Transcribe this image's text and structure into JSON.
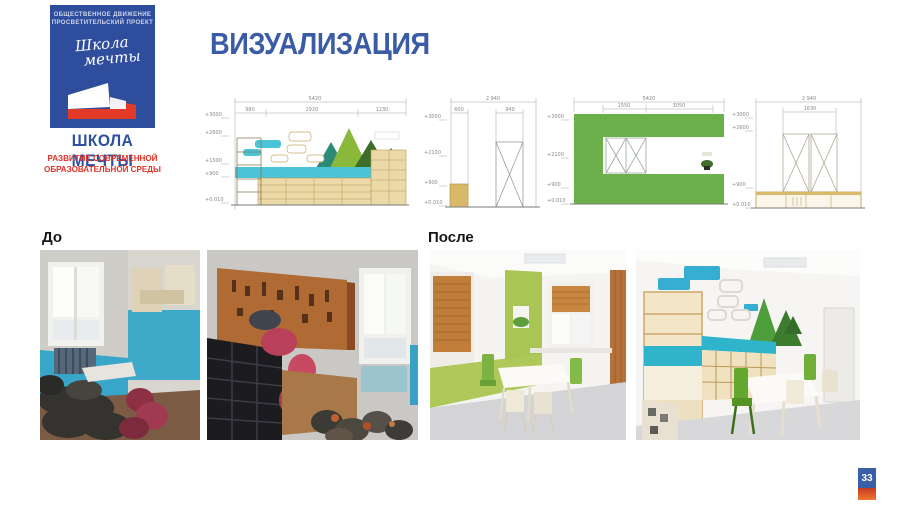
{
  "slide": {
    "title": "ВИЗУАЛИЗАЦИЯ",
    "page_number": "33"
  },
  "logo": {
    "org_line1": "ОБЩЕСТВЕННОЕ ДВИЖЕНИЕ",
    "org_line2": "ПРОСВЕТИТЕЛЬСКИЙ ПРОЕКТ",
    "script_line1": "Школа",
    "script_line2": "мечты",
    "name": "ШКОЛА МЕЧТЫ",
    "tagline_line1": "РАЗВИТИЕ СОВРЕМЕННОЙ",
    "tagline_line2": "ОБРАЗОВАТЕЛЬНОЙ СРЕДЫ",
    "colors": {
      "box_blue": "#2e4d9c",
      "accent_red": "#e23226",
      "name_blue": "#2d4fa0"
    }
  },
  "sections": {
    "before_label": "До",
    "after_label": "После"
  },
  "drawings": [
    {
      "name": "wall-elevation-shelving-mural",
      "total_width": "5420",
      "segments": [
        "980",
        "2920",
        "1230"
      ],
      "heights": [
        "+3000",
        "+2600",
        "+1500",
        "+900",
        "+0.010"
      ]
    },
    {
      "name": "door-wall-elevation",
      "total_width": "2 940",
      "segments": [
        "600",
        "940"
      ],
      "heights": [
        "+3000",
        "+2100",
        "+900",
        "+0.010"
      ]
    },
    {
      "name": "green-wall-window-elevation",
      "total_width": "5420",
      "segments": [
        "1550",
        "3050"
      ],
      "heights": [
        "+3000",
        "+2100",
        "+900",
        "+0.010"
      ]
    },
    {
      "name": "window-wall-cabinet-elevation",
      "total_width": "2 940",
      "segments": [
        "1630"
      ],
      "heights": [
        "+3000",
        "+2600",
        "+900",
        "+0.010"
      ]
    }
  ],
  "photos": [
    {
      "alt": "Before photo 1: old room with blue lower walls, window, piles of dark and red sacks on floor"
    },
    {
      "alt": "Before photo 2: cluttered workshop with pegboard wall of tools, stacked black crates, bags, window"
    },
    {
      "alt": "After photo 1: renovated room with green and white walls, wooden blinds, white table and green chairs"
    },
    {
      "alt": "After photo 2: renovated room with cloud and tree wall decor, wooden cubby shelving, table and chairs"
    }
  ],
  "drawing_colors": {
    "water_blue": "#4cc4d8",
    "wood_tan": "#ecd9a8",
    "wall_green": "#6cb04c"
  }
}
